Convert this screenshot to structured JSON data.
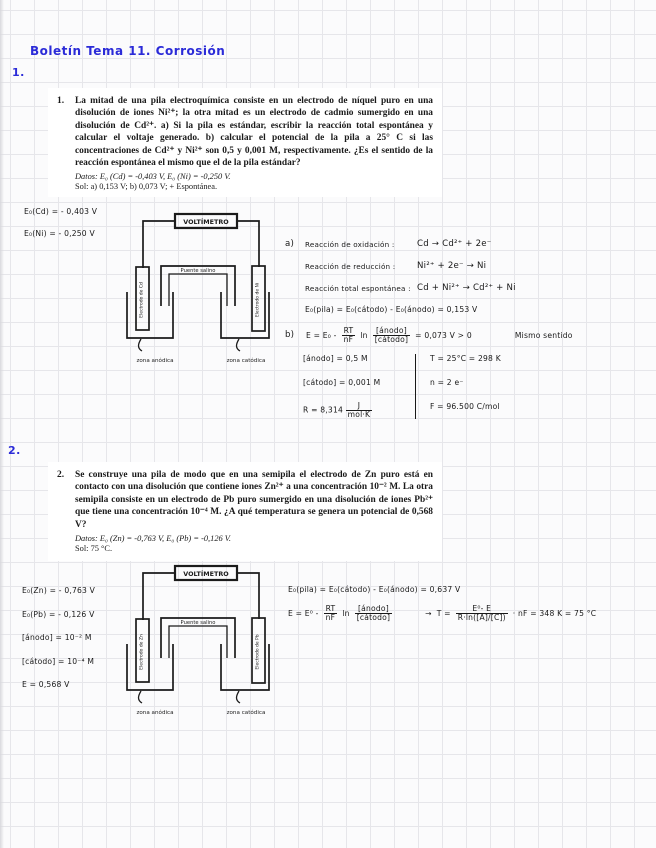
{
  "page": {
    "title": "Boletín Tema 11. Corrosión",
    "margin_number_1": "1.",
    "margin_number_2": "2."
  },
  "colors": {
    "ink_blue": "#2b2bd8",
    "ink_black": "#181818",
    "grid_line": "#e6e6ea",
    "paper": "#fbfbfc"
  },
  "problem1": {
    "number": "1.",
    "body": "La mitad de una pila electroquímica consiste en un electrodo de níquel puro en una disolución de iones Ni²⁺; la otra mitad es un electrodo de cadmio sumergido en una disolución de Cd²⁺. a) Si la pila es estándar, escribir la reacción total espontánea y calcular el voltaje generado. b) calcular el potencial de la pila a 25° C si las concentraciones de Cd²⁺ y Ni²⁺ son 0,5 y 0,001 M, respectivamente. ¿Es el sentido de la reacción espontánea el mismo que el de la pila estándar?",
    "datos": "Datos: E₀ (Cd) = -0,403 V, E₀ (Ni) = -0,250 V.",
    "sol": "Sol: a) 0,153 V; b) 0,073 V; + Espontánea."
  },
  "problem2": {
    "number": "2.",
    "body": "Se construye una pila de modo que en una semipila el electrodo de Zn puro está en contacto con una disolución que contiene iones Zn²⁺ a una concentración 10⁻² M. La otra semipila consiste en un electrodo de Pb puro sumergido en una disolución de iones Pb²⁺ que tiene una concentración 10⁻⁴ M. ¿A qué temperatura se genera un potencial de 0,568 V?",
    "datos": "Datos: E₀ (Zn) = -0,763 V, E₀ (Pb) = -0,126 V.",
    "sol": "Sol: 75 °C."
  },
  "notes1": {
    "line1": "E₀(Cd) = - 0,403 V",
    "line2": "E₀(Ni) = - 0,250 V"
  },
  "diagram1": {
    "voltmeter": "VOLTÍMETRO",
    "bridge": "Puente salino",
    "left_electrode": "Electrodo de Cd",
    "right_electrode": "Electrodo de Ni",
    "left_zone": "zona anódica",
    "right_zone": "zona catódica"
  },
  "section_a": {
    "label": "a)",
    "ox_label": "Reacción de oxidación :",
    "ox_eq": "Cd → Cd²⁺ + 2e⁻",
    "red_label": "Reacción de reducción :",
    "red_eq": "Ni²⁺ + 2e⁻ → Ni",
    "total_label": "Reacción total espontánea :",
    "total_eq": "Cd + Ni²⁺ → Cd²⁺ + Ni",
    "e_pila": "E₀(pila) = E₀(cátodo) - E₀(ánodo) = 0,153 V"
  },
  "section_b": {
    "label": "b)",
    "lhs": "E = E₀ -",
    "frac1_num": "RT",
    "frac1_den": "nF",
    "ln": "ln",
    "frac2_num": "[ánodo]",
    "frac2_den": "[cátodo]",
    "result": "= 0,073 V > 0",
    "note": "Mismo sentido",
    "anodo": "[ánodo] = 0,5 M",
    "catodo": "[cátodo] = 0,001 M",
    "r_lhs": "R = 8,314",
    "r_num": "J",
    "r_den": "mol·K",
    "t": "T = 25°C = 298 K",
    "n": "n = 2 e⁻",
    "f": "F = 96.500 C/mol"
  },
  "notes2": {
    "line1": "E₀(Zn) = - 0,763 V",
    "line2": "E₀(Pb) = - 0,126 V",
    "line3": "[ánodo] = 10⁻² M",
    "line4": "[cátodo] = 10⁻⁴ M",
    "line5": "E = 0,568 V"
  },
  "diagram2": {
    "voltmeter": "VOLTÍMETRO",
    "bridge": "Puente salino",
    "left_electrode": "Electrodo de Zn",
    "right_electrode": "Electrodo de Pb",
    "left_zone": "zona anódica",
    "right_zone": "zona catódica"
  },
  "section_p2": {
    "e_pila": "E₀(pila) = E₀(cátodo) - E₀(ánodo) = 0,637 V",
    "lhs": "E = E⁰ -",
    "frac1_num": "RT",
    "frac1_den": "nF",
    "ln": "ln",
    "frac2_num": "[ánodo]",
    "frac2_den": "[cátodo]",
    "arrow": "→",
    "t_lhs": "T =",
    "t_num": "E⁰- E",
    "t_den": "R·ln([A]/[C])",
    "t_rhs": "· nF = 348 K = 75 °C"
  }
}
